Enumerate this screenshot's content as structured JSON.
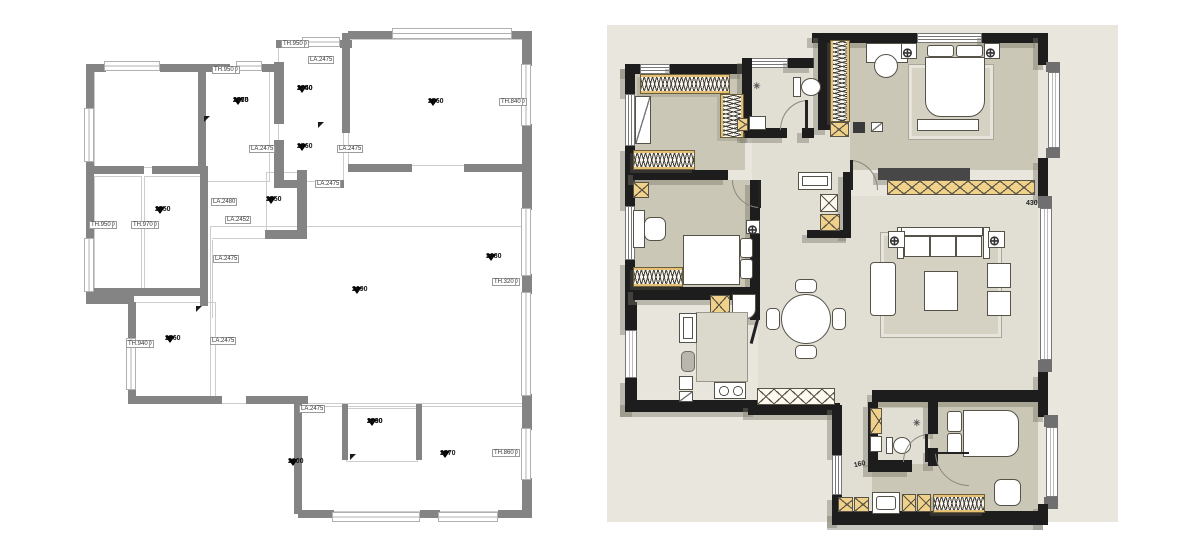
{
  "palette": {
    "panel_bg": "#e9e6de",
    "room_floor": "#cbc7b6",
    "hall_floor": "#e1ded4",
    "wall_black": "#1d1d1d",
    "wall_gray_left_plan": "#848484",
    "cabinet_accent": "#e6c175"
  },
  "left_plan": {
    "markers": [
      {
        "v1": "2735",
        "v2": "2470"
      },
      {
        "v1": "2740",
        "v2": "2450"
      },
      {
        "v1": "2760"
      },
      {
        "v1": "2760"
      },
      {
        "v1": "2750"
      },
      {
        "v1": "2750"
      },
      {
        "v1": "2690"
      },
      {
        "v1": "2680"
      },
      {
        "v1": "2760"
      },
      {
        "v1": "2730",
        "v2": "2490"
      },
      {
        "v1": "2900"
      },
      {
        "v1": "2770"
      }
    ],
    "tags": [
      {
        "l1": "CH.1440",
        "l2": "TH.950"
      },
      {
        "l1": "CH.1480",
        "l2": "TH.950"
      },
      {
        "l1": "LA.75",
        "l2": "LA.2475"
      },
      {
        "l1": "CH.1030",
        "l2": "TH.840"
      },
      {
        "l1": "LA.215",
        "l2": "LA.2475"
      },
      {
        "l1": "LA.75",
        "l2": "LA.2475"
      },
      {
        "l1": "LA.250",
        "l2": "LA.2475"
      },
      {
        "l1": "LA.215",
        "l2": "LA.2480"
      },
      {
        "l1": "LA.80",
        "l2": "LA.2452"
      },
      {
        "l1": "CH.1430",
        "l2": "TH.950"
      },
      {
        "l1": "CH.1390",
        "l2": "TH.970"
      },
      {
        "l1": "LA.80",
        "l2": "LA.2475"
      },
      {
        "l1": "CH.2030",
        "l2": "TH.320"
      },
      {
        "l1": "CH.1390",
        "l2": "TH.940"
      },
      {
        "l1": "LA.230",
        "l2": "LA.2475"
      },
      {
        "l1": "LA.220",
        "l2": "LA.2475"
      },
      {
        "l1": "CH.1090",
        "l2": "TH.860"
      }
    ]
  },
  "right_plan": {
    "dims": {
      "living_window": "430",
      "bathroom": "160"
    }
  }
}
